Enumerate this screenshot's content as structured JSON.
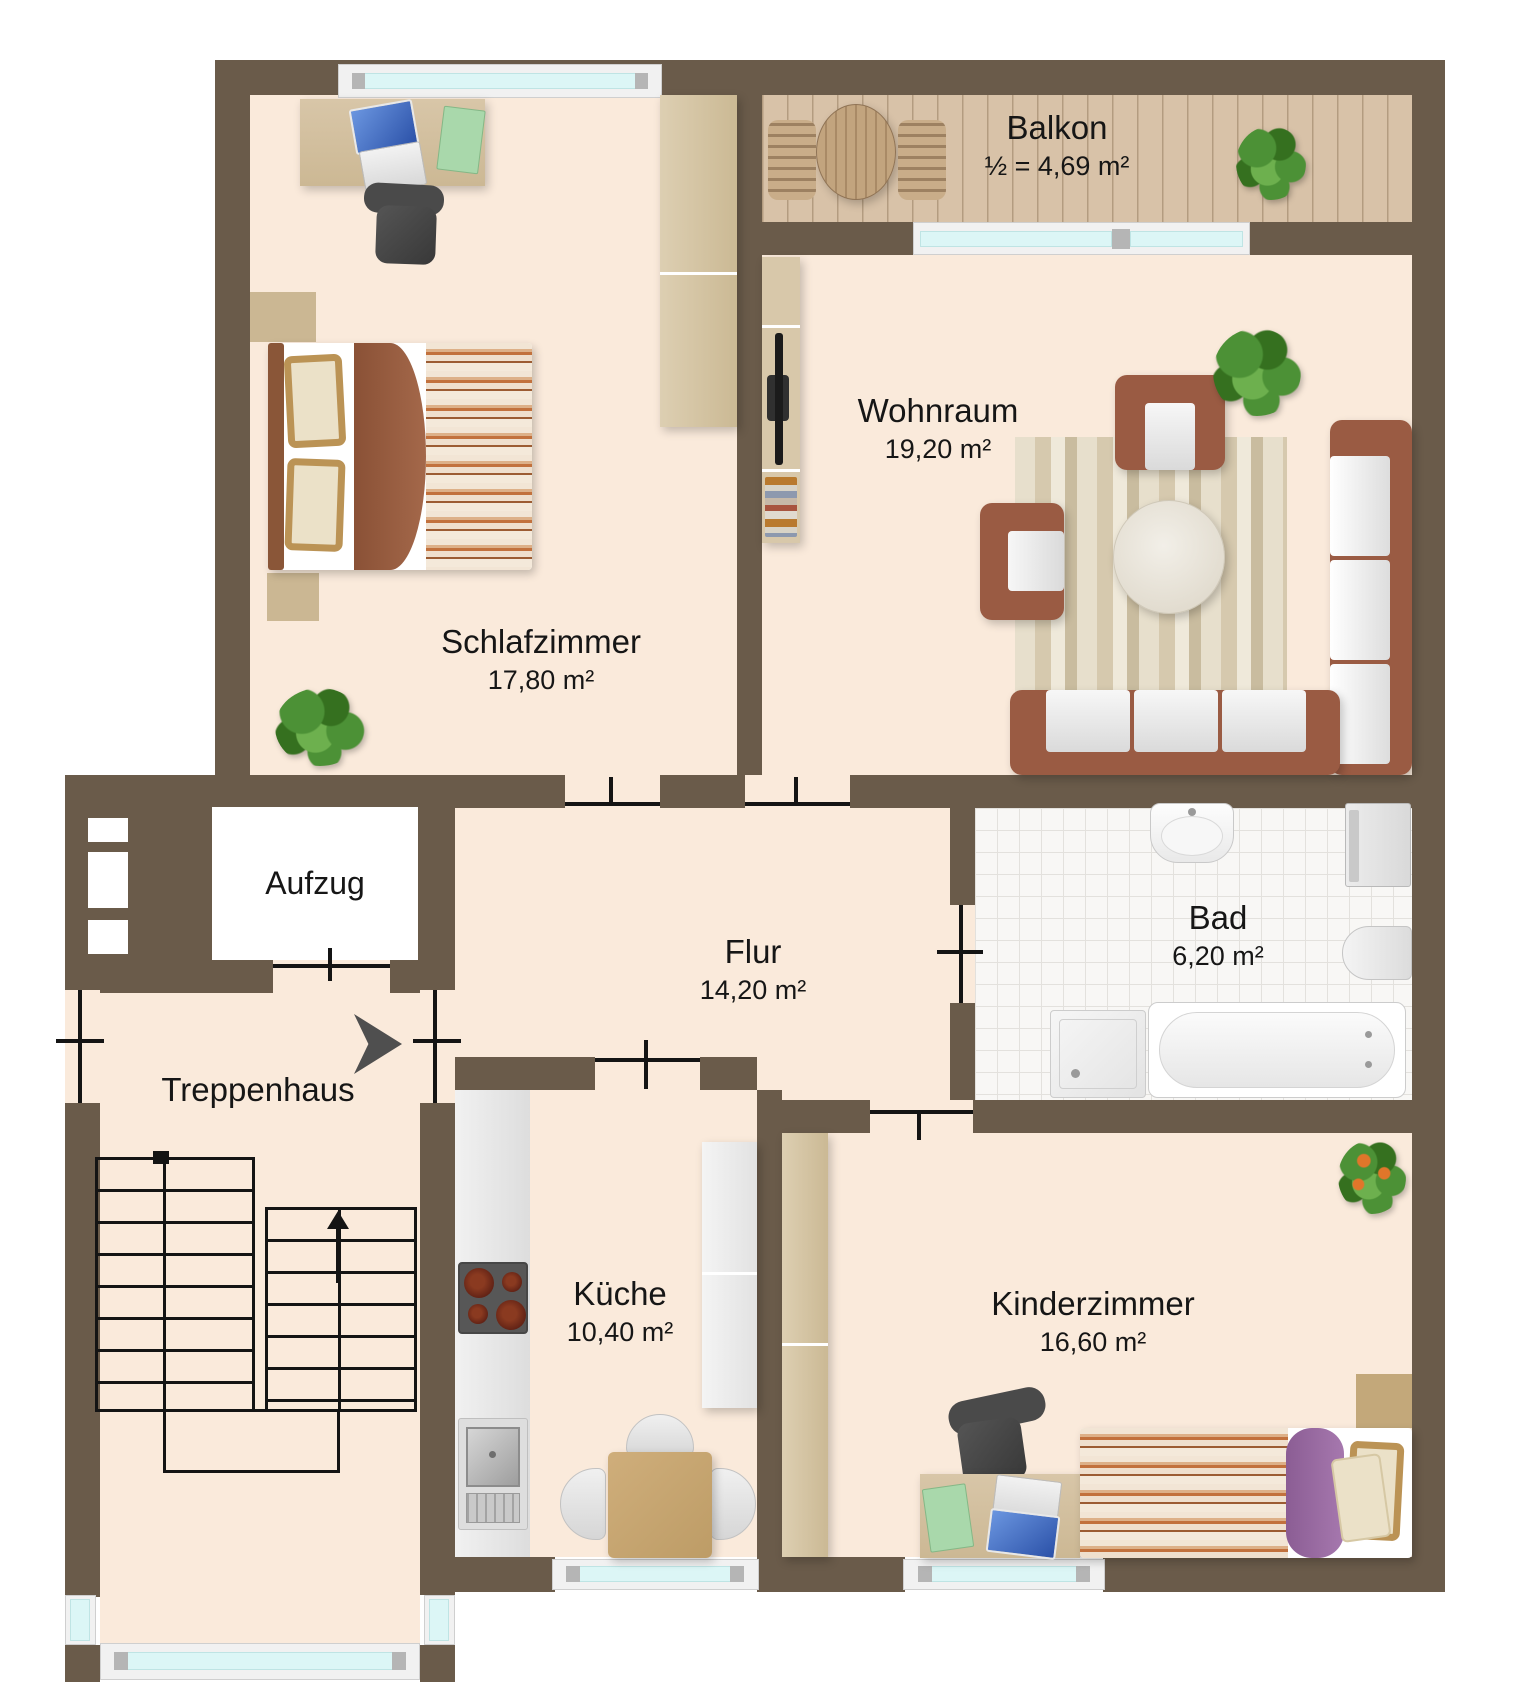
{
  "rooms": {
    "balkon": {
      "name": "Balkon",
      "area": "½ = 4,69 m²"
    },
    "wohnraum": {
      "name": "Wohnraum",
      "area": "19,20 m²"
    },
    "schlafzimmer": {
      "name": "Schlafzimmer",
      "area": "17,80 m²"
    },
    "aufzug": {
      "name": "Aufzug"
    },
    "flur": {
      "name": "Flur",
      "area": "14,20 m²"
    },
    "bad": {
      "name": "Bad",
      "area": "6,20 m²"
    },
    "treppenhaus": {
      "name": "Treppenhaus"
    },
    "kueche": {
      "name": "Küche",
      "area": "10,40 m²"
    },
    "kinderzimmer": {
      "name": "Kinderzimmer",
      "area": "16,60 m²"
    }
  },
  "colors": {
    "wall": "#6a5b4a",
    "floor": "#faeadb",
    "balcony_wood": "#d8c2a8",
    "plank_line": "#bca586",
    "tile": "#f8f7f5",
    "tile_line": "#e3e1dd",
    "glass": "#dcf6f6",
    "frame": "#f1f1f1",
    "frame_cap": "#b5b5b5",
    "wood_light": "#d8c8aa",
    "wood_desk": "#d3c0a0",
    "wood_dark": "#8a5638",
    "sofa": "#9a5b43",
    "cushion": "#ececec",
    "rug_a": "#e7dfcc",
    "rug_b": "#d6c9ae",
    "table_tan": "#c7a772",
    "purple": "#96689f",
    "folder_green": "#a9d8ab",
    "laptop_blue": "#3f6fc4",
    "plant_green": "#4c9136",
    "plant_dark": "#35701f",
    "plant_orange": "#e0762a",
    "chair_gray": "#454545",
    "appliance": "#e6e6e6",
    "steel": "#b9b9b9",
    "stove_gray": "#575757",
    "burner": "#5e2014",
    "pillow_tan": "#bb9355",
    "pillow_cream": "#ebe1c8",
    "stairs": "#141414",
    "label": "#161616",
    "arrow": "#4f4f4f"
  }
}
